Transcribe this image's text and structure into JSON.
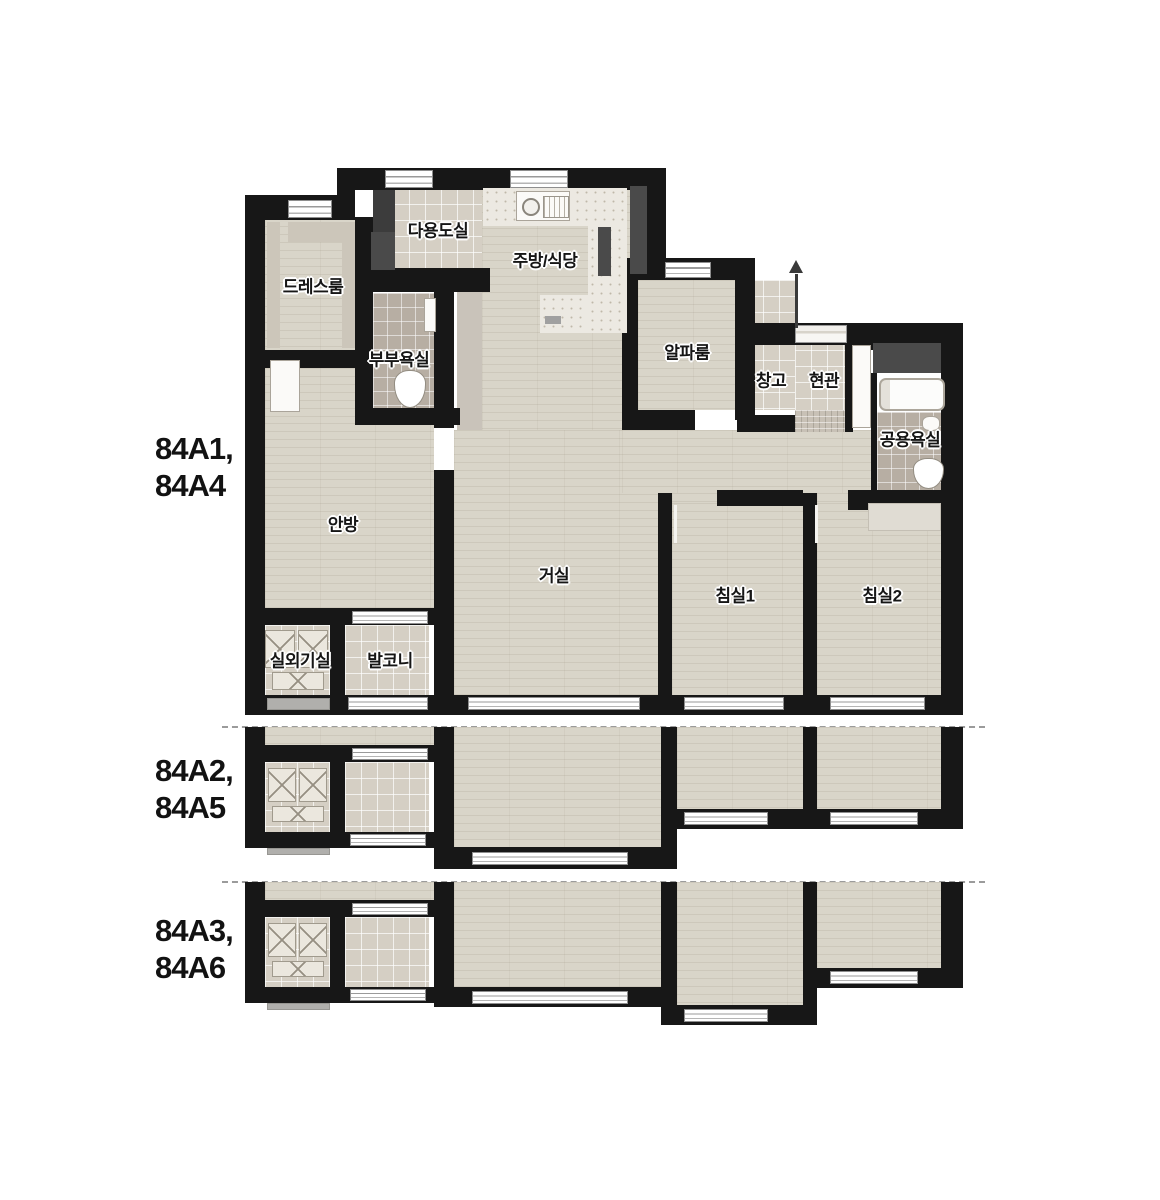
{
  "units": {
    "main": {
      "line1": "84A1,",
      "line2": "84A4"
    },
    "mid": {
      "line1": "84A2,",
      "line2": "84A5"
    },
    "bottom": {
      "line1": "84A3,",
      "line2": "84A6"
    }
  },
  "rooms": {
    "dress": "드레스룸",
    "utility": "다용도실",
    "kitchen": "주방/식당",
    "master_bath": "부부욕실",
    "alpha": "알파룸",
    "storage": "창고",
    "entry": "현관",
    "common_bath": "공용욕실",
    "master_bed": "안방",
    "living": "거실",
    "bed1": "침실1",
    "bed2": "침실2",
    "ac_room": "실외기실",
    "balcony": "발코니"
  },
  "colors": {
    "background": "#ffffff",
    "wall": "#171717",
    "wood_floor": "#d9d5c9",
    "tile_floor": "#d5cfc4",
    "bath_tile": "#b7aea3",
    "counter": "#ece9e2",
    "closet_dark": "#4a4a4a",
    "label_text": "#161616"
  }
}
